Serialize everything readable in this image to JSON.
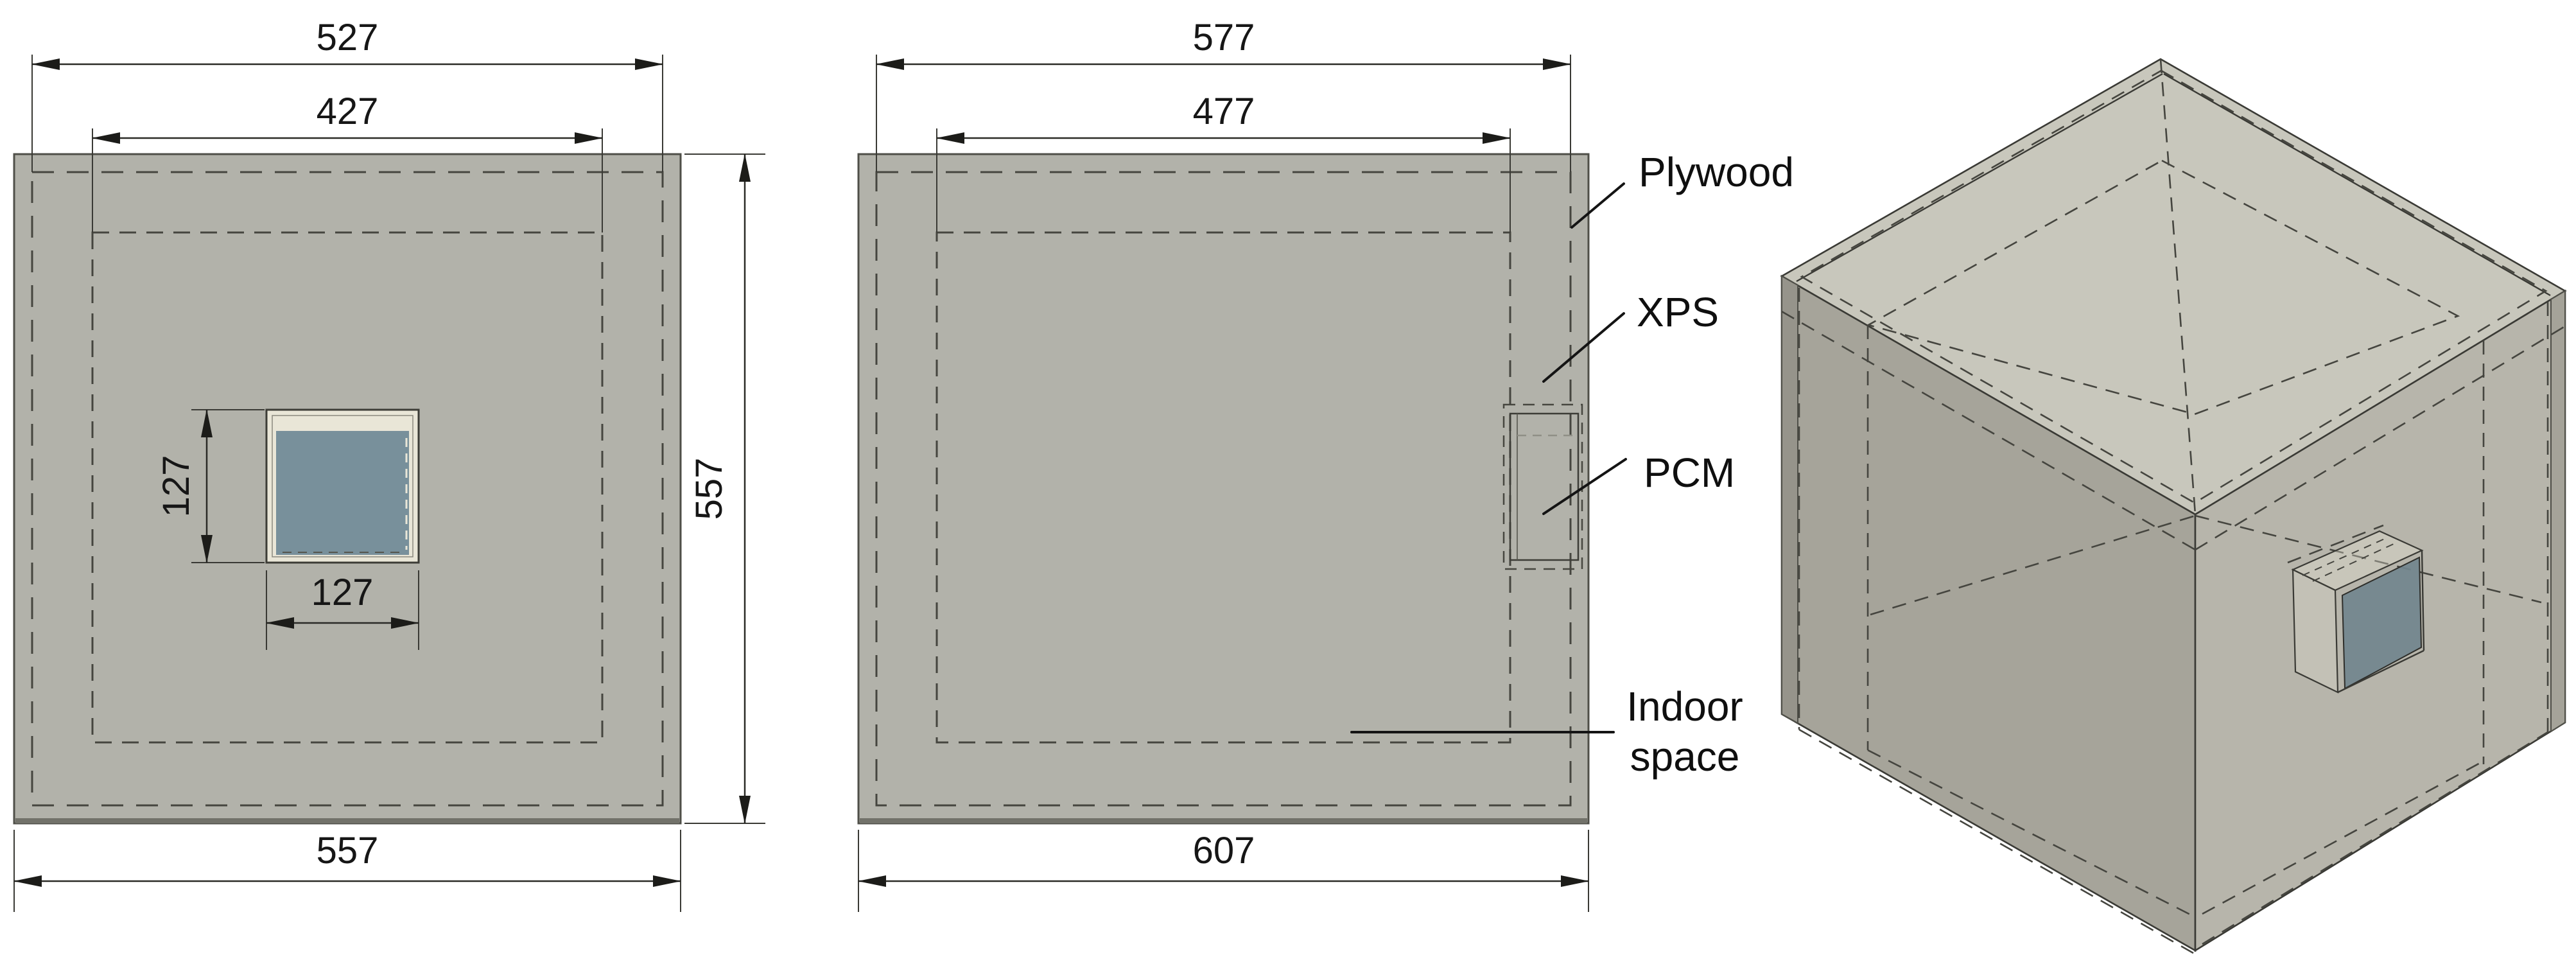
{
  "figure": {
    "description": "Technical drawing of insulated test box with PCM panel: front view, side view and isometric view",
    "units_implied": "mm"
  },
  "front_view": {
    "dim_top_outer": "527",
    "dim_top_inner": "427",
    "dim_right_height": "557",
    "dim_bottom_width": "557",
    "pcm_dim_height": "127",
    "pcm_dim_width": "127"
  },
  "side_view": {
    "dim_top_outer": "577",
    "dim_top_inner": "477",
    "dim_bottom_width": "607"
  },
  "legend": {
    "plywood": "Plywood",
    "xps": "XPS",
    "pcm": "PCM",
    "indoor_line1": "Indoor",
    "indoor_line2": "space"
  },
  "colors": {
    "panel_gray": "#b2b2aa",
    "iso_top_face": "#c8c7bc",
    "iso_left_face": "#a6a49a",
    "iso_right_face": "#b7b5ab",
    "pcm_blue": "#78909b",
    "pcm_slab_blue": "#72858e",
    "frame_cream": "#e9e6d7",
    "line_dark": "#3a3a35",
    "background": "#ffffff"
  }
}
